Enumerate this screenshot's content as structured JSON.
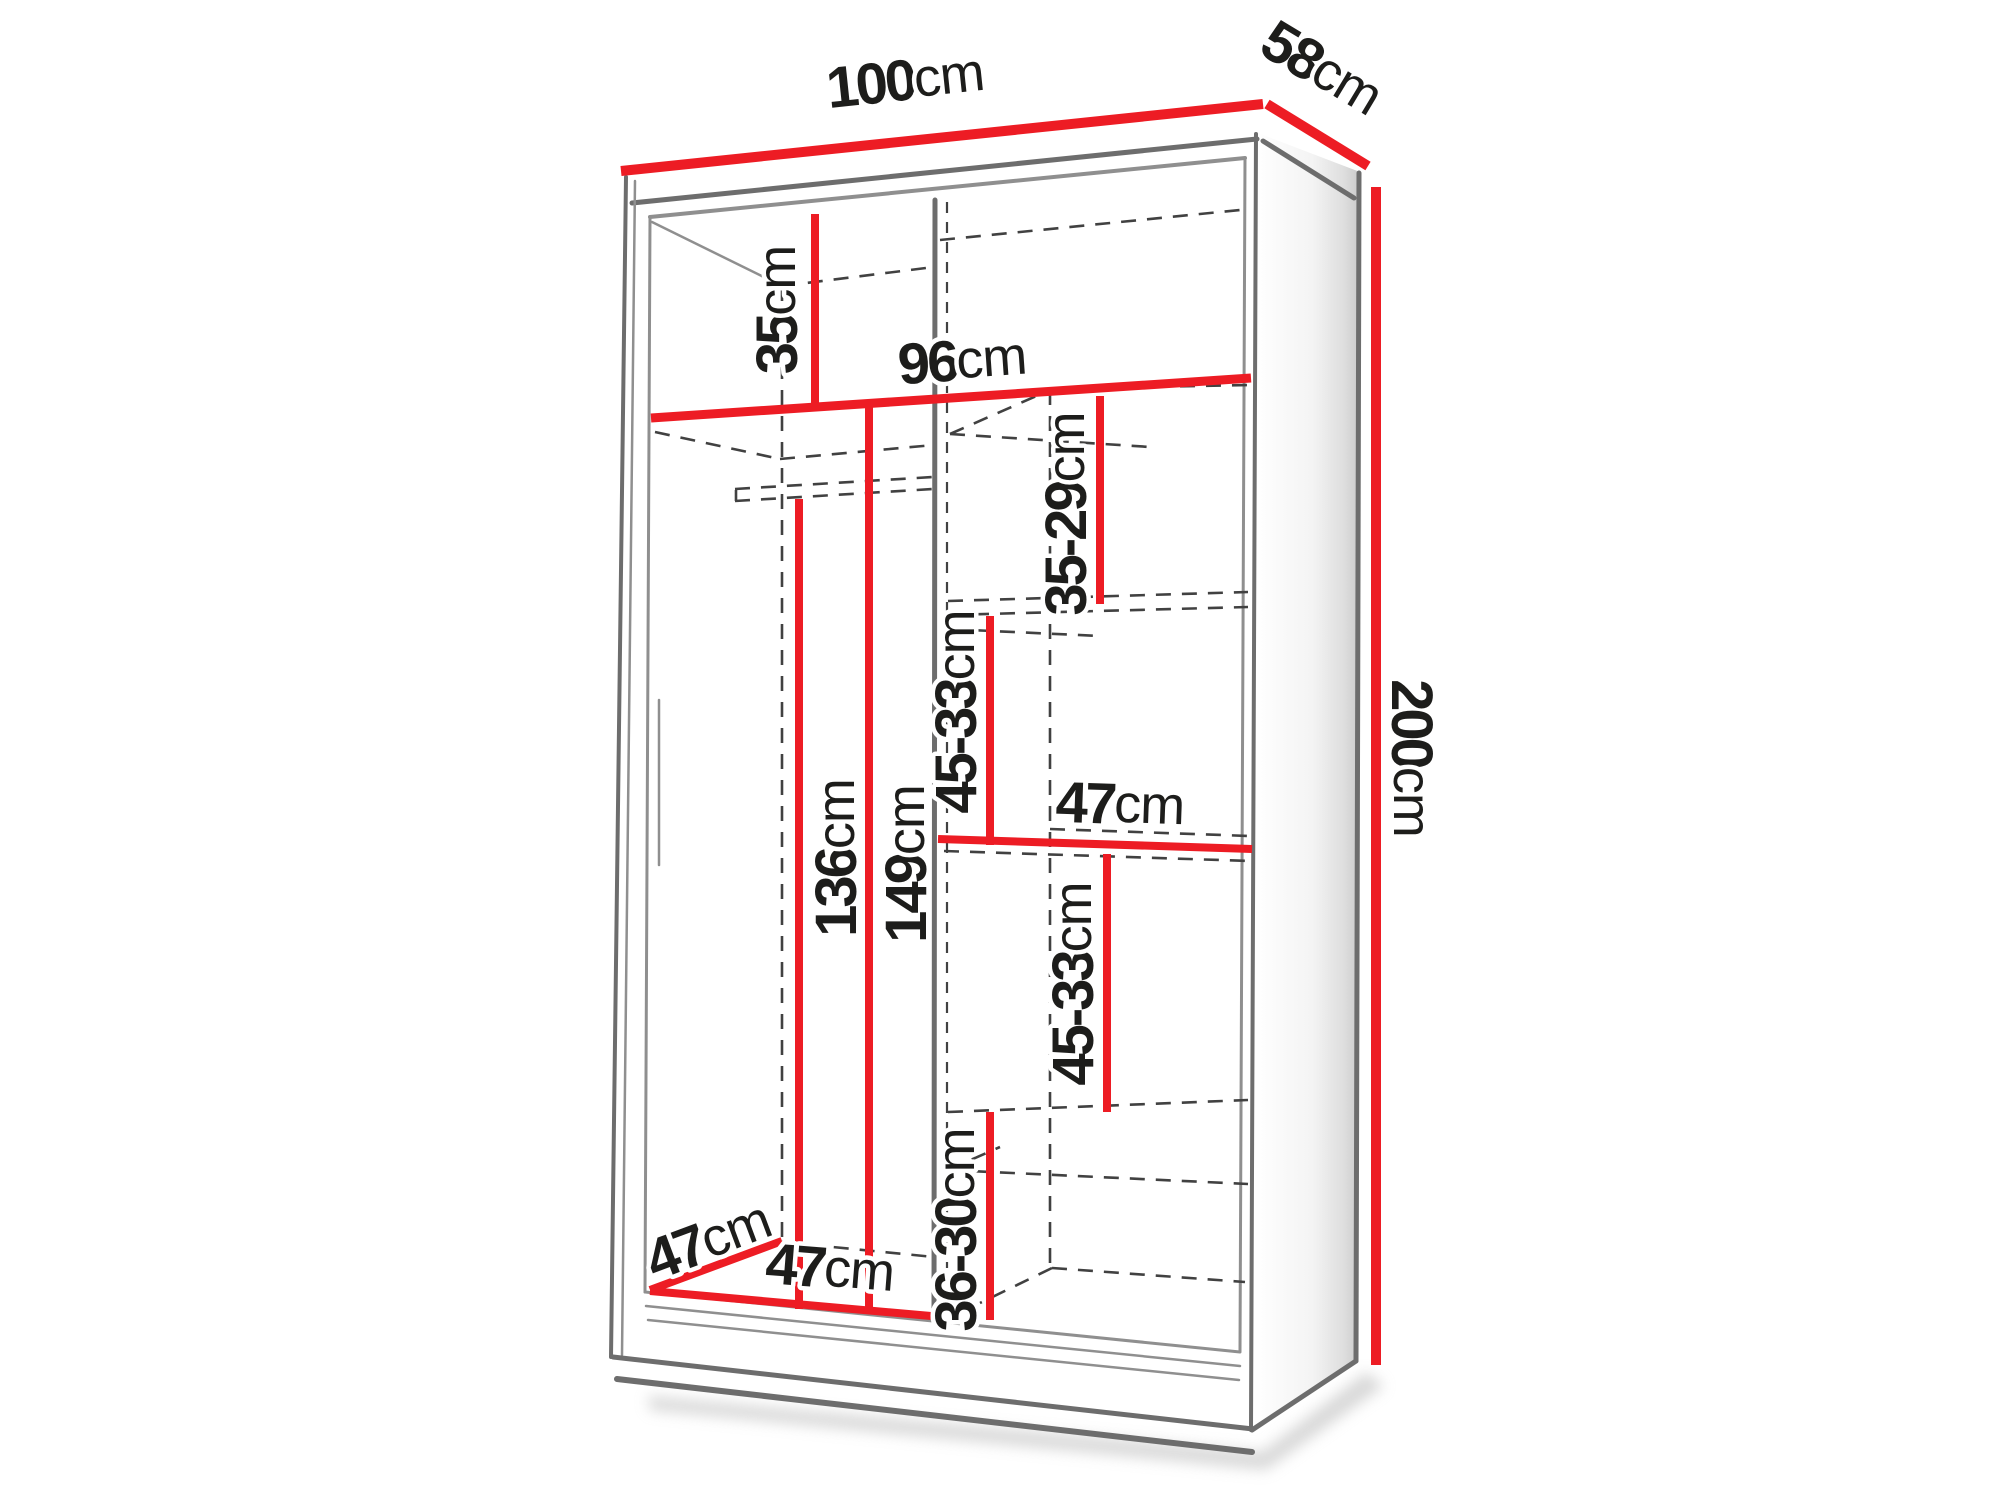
{
  "diagram": {
    "type": "furniture-dimension-diagram",
    "subject": "two-door sliding wardrobe with shelves and hanging rail",
    "unit": "cm",
    "colors": {
      "dimension_line": "#ed1c24",
      "outline": "#6d6d6d",
      "hidden_line": "#414141",
      "label_text": "#1d1d1b",
      "background": "#ffffff"
    },
    "overall": {
      "width": "100",
      "depth": "58",
      "height": "200"
    }
  },
  "labels": [
    {
      "id": "overall-width",
      "value": "100",
      "unit": "cm"
    },
    {
      "id": "overall-depth",
      "value": "58",
      "unit": "cm"
    },
    {
      "id": "overall-height",
      "value": "200",
      "unit": "cm"
    },
    {
      "id": "top-section-height",
      "value": "35",
      "unit": "cm"
    },
    {
      "id": "interior-width",
      "value": "96",
      "unit": "cm"
    },
    {
      "id": "shelf-gap-top",
      "value": "35-29",
      "unit": "cm"
    },
    {
      "id": "shelf-gap-upper",
      "value": "45-33",
      "unit": "cm"
    },
    {
      "id": "right-section-width",
      "value": "47",
      "unit": "cm"
    },
    {
      "id": "shelf-gap-lower",
      "value": "45-33",
      "unit": "cm"
    },
    {
      "id": "shelf-gap-bottom",
      "value": "36-30",
      "unit": "cm"
    },
    {
      "id": "rail-clearance-height",
      "value": "136",
      "unit": "cm"
    },
    {
      "id": "left-section-height",
      "value": "149",
      "unit": "cm"
    },
    {
      "id": "left-section-depth",
      "value": "47",
      "unit": "cm"
    },
    {
      "id": "left-section-width",
      "value": "47",
      "unit": "cm"
    }
  ]
}
